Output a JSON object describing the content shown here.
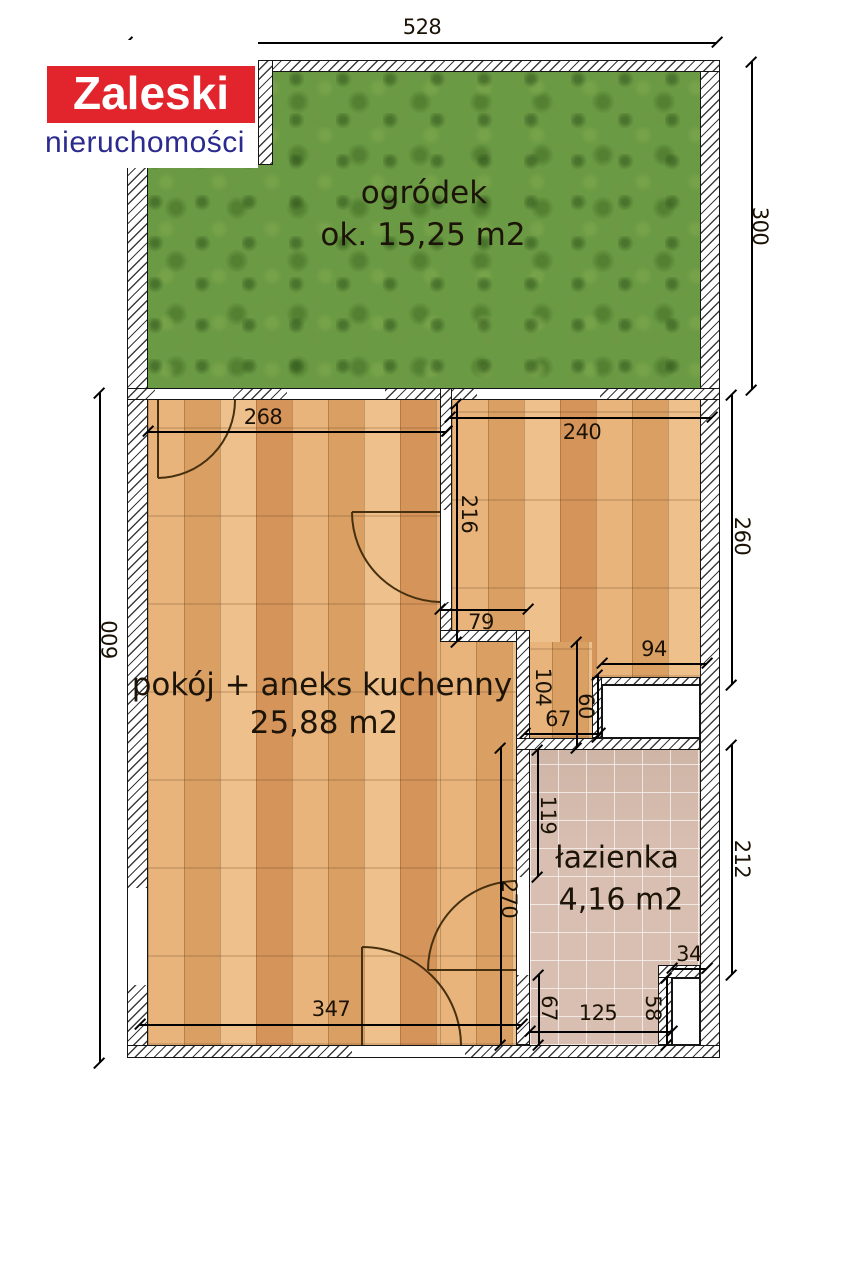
{
  "logo": {
    "brand": "Zaleski",
    "subtitle": "nieruchomości",
    "brand_bg_color": "#e2242c",
    "brand_text_color": "#ffffff",
    "subtitle_color": "#2b2a8e"
  },
  "rooms": {
    "garden": {
      "label": "ogródek",
      "area": "ok. 15,25 m2"
    },
    "living": {
      "label": "pokój + aneks kuchenny",
      "area": "25,88 m2"
    },
    "bathroom": {
      "label": "łazienka",
      "area": "4,16 m2"
    }
  },
  "colors": {
    "grass": "#6a9a43",
    "wood": "#e0a76f",
    "tile": "#d8bfb1",
    "dimension_text": "#1b1206"
  },
  "dimensions": [
    {
      "label": "528",
      "orient": "h",
      "x": 127,
      "y": 42,
      "len": 590,
      "lx": 422,
      "ly": 27,
      "rot": 0
    },
    {
      "label": "300",
      "orient": "v",
      "x": 751,
      "y": 62,
      "len": 328,
      "lx": 760,
      "ly": 226,
      "rot": 90
    },
    {
      "label": "600",
      "orient": "v",
      "x": 99,
      "y": 393,
      "len": 670,
      "lx": 110,
      "ly": 640,
      "rot": -90
    },
    {
      "label": "268",
      "orient": "h",
      "x": 148,
      "y": 431,
      "len": 299,
      "lx": 263,
      "ly": 417,
      "rot": 0
    },
    {
      "label": "240",
      "orient": "h",
      "x": 450,
      "y": 417,
      "len": 262,
      "lx": 582,
      "ly": 432,
      "rot": 0
    },
    {
      "label": "216",
      "orient": "v",
      "x": 456,
      "y": 404,
      "len": 238,
      "lx": 469,
      "ly": 514,
      "rot": 90
    },
    {
      "label": "79",
      "orient": "h",
      "x": 440,
      "y": 609,
      "len": 88,
      "lx": 481,
      "ly": 622,
      "rot": 0
    },
    {
      "label": "94",
      "orient": "h",
      "x": 602,
      "y": 663,
      "len": 105,
      "lx": 654,
      "ly": 649,
      "rot": 0
    },
    {
      "label": "104",
      "orient": "v",
      "x": 576,
      "y": 642,
      "len": 106,
      "lx": 543,
      "ly": 687,
      "rot": 90
    },
    {
      "label": "67",
      "orient": "h",
      "x": 525,
      "y": 733,
      "len": 75,
      "lx": 558,
      "ly": 719,
      "rot": 0
    },
    {
      "label": "60",
      "orient": "v",
      "x": 597,
      "y": 675,
      "len": 62,
      "lx": 586,
      "ly": 706,
      "rot": 90
    },
    {
      "label": "119",
      "orient": "v",
      "x": 537,
      "y": 750,
      "len": 127,
      "lx": 548,
      "ly": 815,
      "rot": 90
    },
    {
      "label": "270",
      "orient": "v",
      "x": 500,
      "y": 748,
      "len": 297,
      "lx": 509,
      "ly": 899,
      "rot": 90
    },
    {
      "label": "347",
      "orient": "h",
      "x": 140,
      "y": 1024,
      "len": 382,
      "lx": 331,
      "ly": 1009,
      "rot": 0
    },
    {
      "label": "67",
      "orient": "v",
      "x": 538,
      "y": 975,
      "len": 70,
      "lx": 549,
      "ly": 1008,
      "rot": 90
    },
    {
      "label": "125",
      "orient": "h",
      "x": 530,
      "y": 1031,
      "len": 142,
      "lx": 598,
      "ly": 1013,
      "rot": 0
    },
    {
      "label": "58",
      "orient": "v",
      "x": 666,
      "y": 978,
      "len": 67,
      "lx": 653,
      "ly": 1008,
      "rot": 90
    },
    {
      "label": "34",
      "orient": "h",
      "x": 672,
      "y": 968,
      "len": 35,
      "lx": 689,
      "ly": 954,
      "rot": 0
    },
    {
      "label": "212",
      "orient": "v",
      "x": 731,
      "y": 745,
      "len": 230,
      "lx": 742,
      "ly": 859,
      "rot": 90
    },
    {
      "label": "260",
      "orient": "v",
      "x": 731,
      "y": 395,
      "len": 290,
      "lx": 742,
      "ly": 536,
      "rot": 90
    }
  ]
}
